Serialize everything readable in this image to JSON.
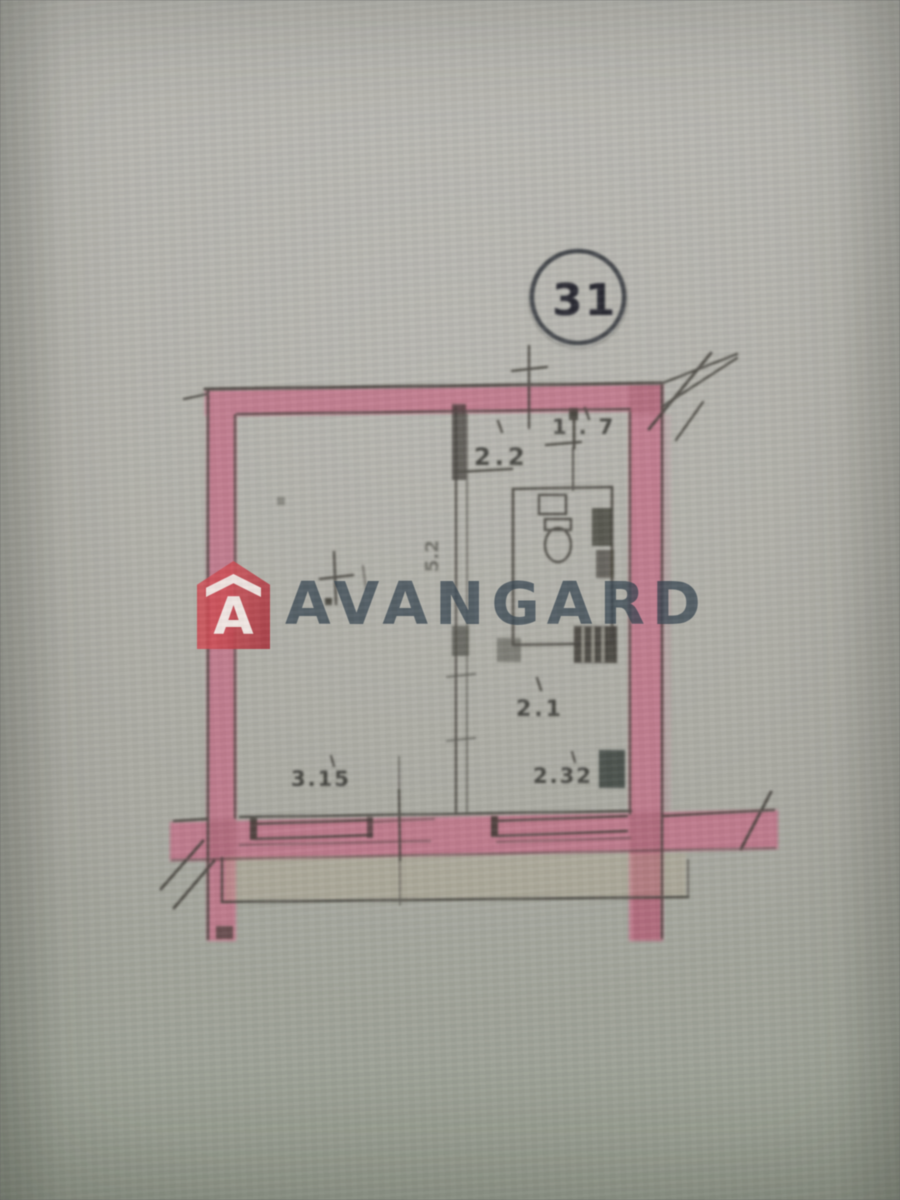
{
  "watermark": {
    "brand": "AVANGARD",
    "logo_letter": "A",
    "logo_color": "#c2454e",
    "text_color": "#364450"
  },
  "plan": {
    "unit_number": "31",
    "labels": {
      "entry_width": "2.2",
      "bath_width": "1.7",
      "hall_depth": "5.2",
      "kitchen_width": "2.1",
      "window_left_width": "3.15",
      "window_right_width": "2.32"
    },
    "colors": {
      "wall_highlight": "#c67089",
      "pencil": "#403e38",
      "paper": "#adaca4"
    }
  }
}
